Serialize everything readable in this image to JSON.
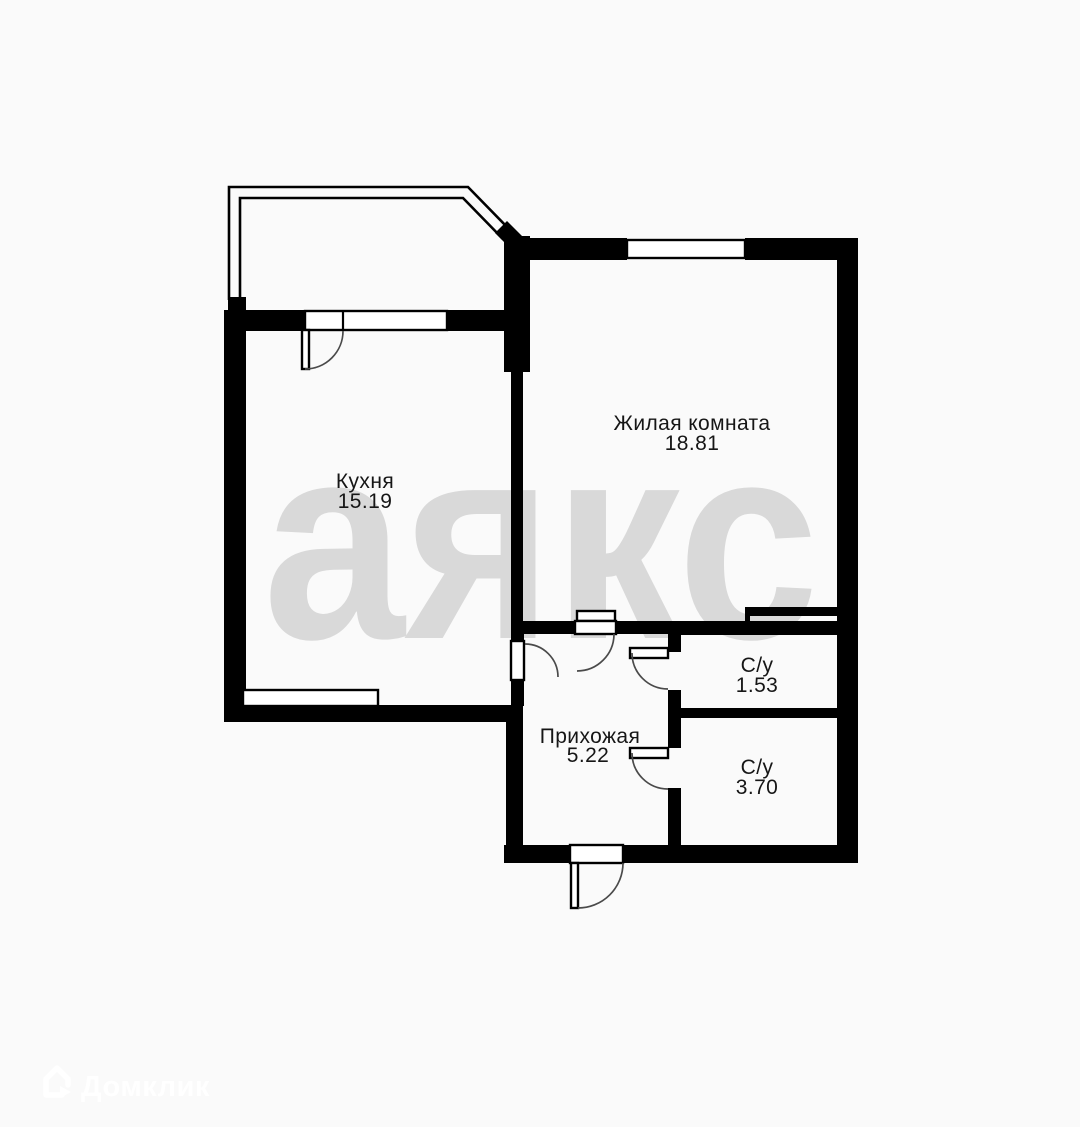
{
  "watermark_text": "аякс",
  "rooms": [
    {
      "name": "Кухня",
      "area": "15.19"
    },
    {
      "name": "Жилая комната",
      "area": "18.81"
    },
    {
      "name": "Прихожая",
      "area": "5.22"
    },
    {
      "name": "С/у",
      "area": "1.53"
    },
    {
      "name": "С/у",
      "area": "3.70"
    }
  ],
  "branding": {
    "logo_text": "Домклик"
  },
  "colors": {
    "background": "#fafafa",
    "wall": "#000000",
    "watermark": "#d9d9d9",
    "label_text": "#161616",
    "logo": "#ffffff"
  }
}
